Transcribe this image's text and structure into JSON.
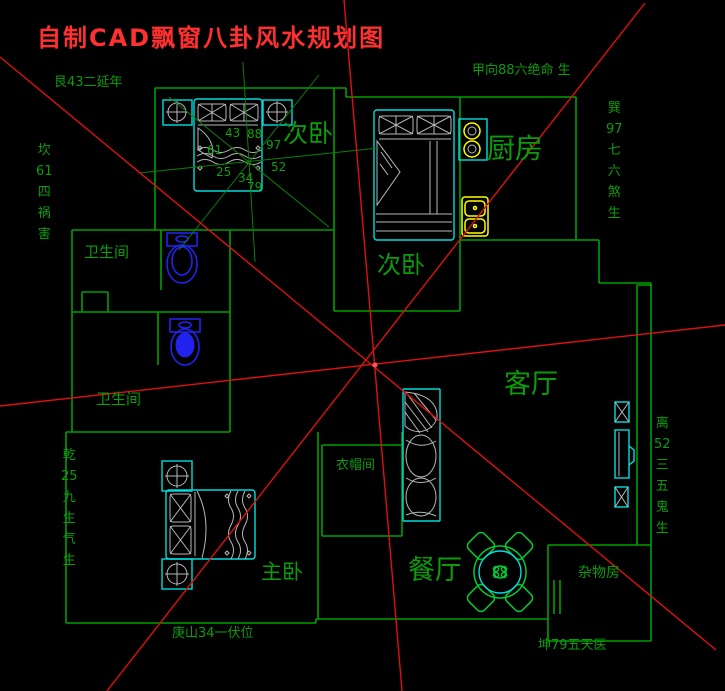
{
  "title": {
    "text": "自制CAD飘窗八卦风水规划图"
  },
  "bagua_labels": {
    "top_left": "艮43二延年",
    "top": "甲向88六绝命 生",
    "left": [
      "坎",
      "61",
      "四",
      "祸",
      "害"
    ],
    "right_upper": [
      "巽",
      "97",
      "七",
      "六",
      "煞",
      "生"
    ],
    "left_lower": [
      "乾",
      "25",
      "九",
      "生",
      "气",
      "生"
    ],
    "right_lower": [
      "离",
      "52",
      "三",
      "五",
      "鬼",
      "生"
    ],
    "bottom": "庚山34一伏位",
    "bottom_right": "坤79五天医"
  },
  "rooms": {
    "bedroom_top": "次卧",
    "kitchen": "厨房",
    "bedroom_mid": "次卧",
    "bathroom_upper": "卫生间",
    "bathroom_lower": "卫生间",
    "living_room": "客厅",
    "cloakroom": "衣帽间",
    "master_bedroom": "主卧",
    "dining_room": "餐厅",
    "storage_room": "杂物房"
  },
  "bed_numbers": [
    "43",
    "88",
    "61",
    "97",
    "25",
    "52",
    "34",
    "79"
  ],
  "colors": {
    "background": "#000000",
    "wall_green": "#00a000",
    "label_green": "#0b9b0b",
    "title_red": "#ff3030",
    "line_red": "#dd1111",
    "furniture_cyan": "#00dede",
    "toilet_blue": "#2222ee",
    "fixture_yellow": "#ffff00",
    "detail_gray": "#b8b8b8",
    "table_green": "#00cc33"
  }
}
